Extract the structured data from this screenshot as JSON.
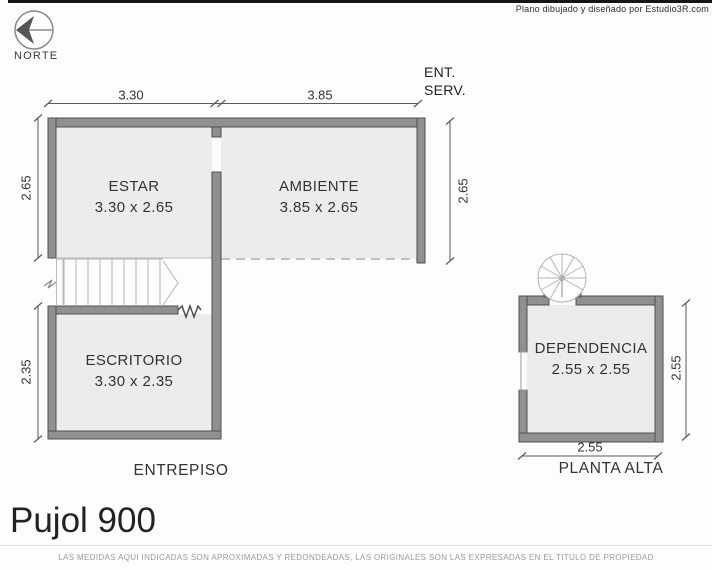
{
  "watermark": "Plano dibujado y diseñado por Estudio3R.com",
  "north": {
    "label": "NORTE"
  },
  "entrepiso": {
    "floor_label": "ENTREPISO",
    "service_entrance": {
      "line1": "ENT.",
      "line2": "SERV."
    },
    "rooms": [
      {
        "name": "ESTAR",
        "size": "3.30 x 2.65"
      },
      {
        "name": "AMBIENTE",
        "size": "3.85 x 2.65"
      },
      {
        "name": "ESCRITORIO",
        "size": "3.30 x 2.35"
      }
    ],
    "dims": {
      "top_left_width": "3.30",
      "top_right_width": "3.85",
      "left_upper_height": "2.65",
      "right_height": "2.65",
      "left_lower_height": "2.35"
    }
  },
  "planta_alta": {
    "floor_label": "PLANTA ALTA",
    "rooms": [
      {
        "name": "DEPENDENCIA",
        "size": "2.55 x 2.55"
      }
    ],
    "dims": {
      "right_height": "2.55",
      "bottom_width": "2.55"
    }
  },
  "title": "Pujol 900",
  "footer_note": "LAS MEDIDAS AQUI INDICADAS SON APROXIMADAS Y REDONDEADAS, LAS ORIGINALES SON LAS EXPRESADAS EN EL TITULO DE PROPIEDAD",
  "colors": {
    "wall": "#909090",
    "floor": "#ececec",
    "top_strip": "#161616"
  }
}
